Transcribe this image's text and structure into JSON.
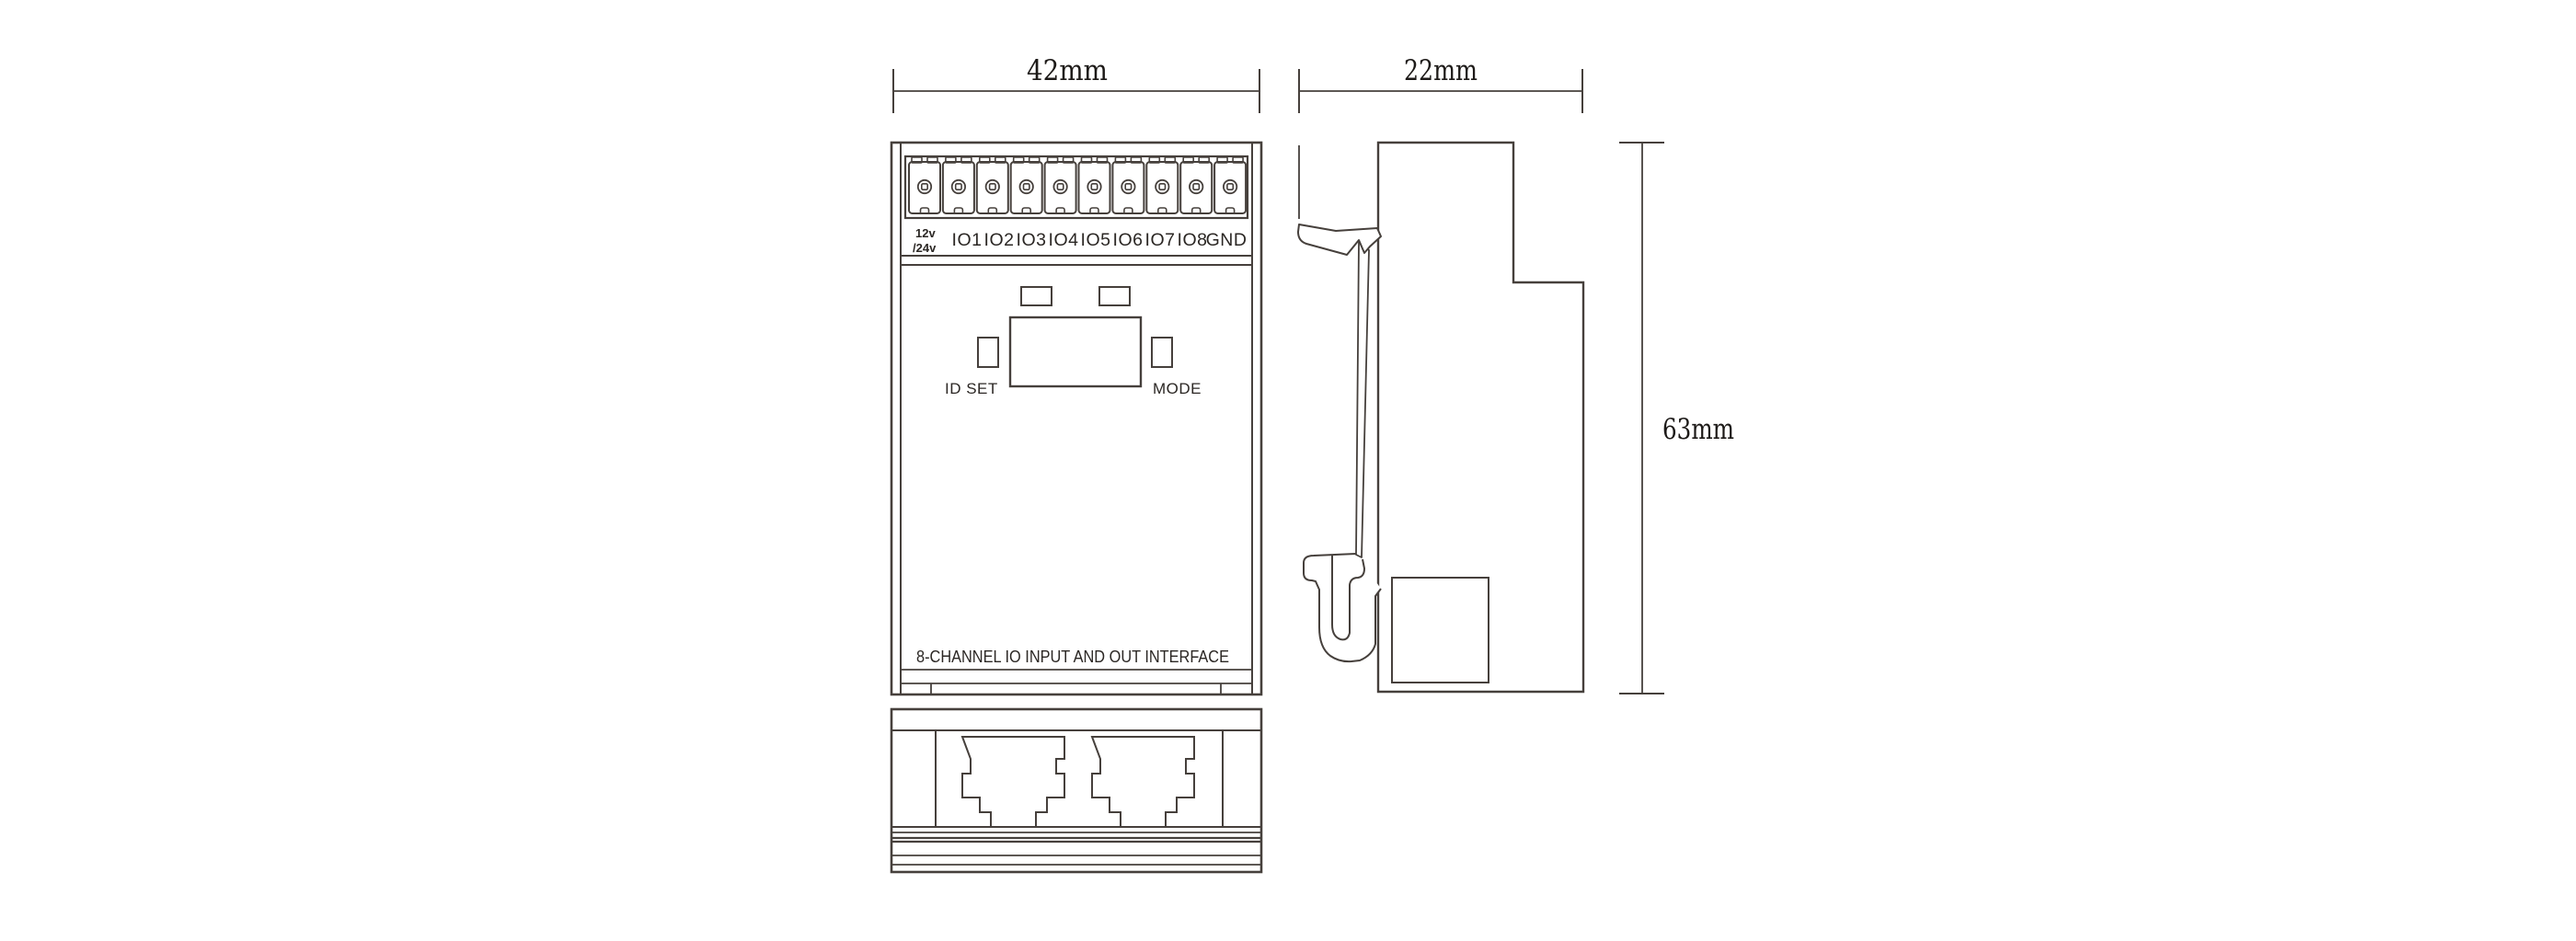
{
  "drawing": {
    "dimensions": {
      "front_width": "42mm",
      "side_width": "22mm",
      "height": "63mm"
    },
    "terminal_row": {
      "power_line1": "12v",
      "power_line2": "/24v",
      "io_labels": [
        "IO1",
        "IO2",
        "IO3",
        "IO4",
        "IO5",
        "IO6",
        "IO7",
        "IO8"
      ],
      "gnd_label": "GND"
    },
    "controls": {
      "id_set_label": "ID SET",
      "mode_label": "MODE"
    },
    "bottom_title": "8-CHANNEL IO INPUT AND OUT INTERFACE",
    "colors": {
      "line": "#46403c",
      "text": "#2b2724",
      "background": "#ffffff"
    }
  }
}
